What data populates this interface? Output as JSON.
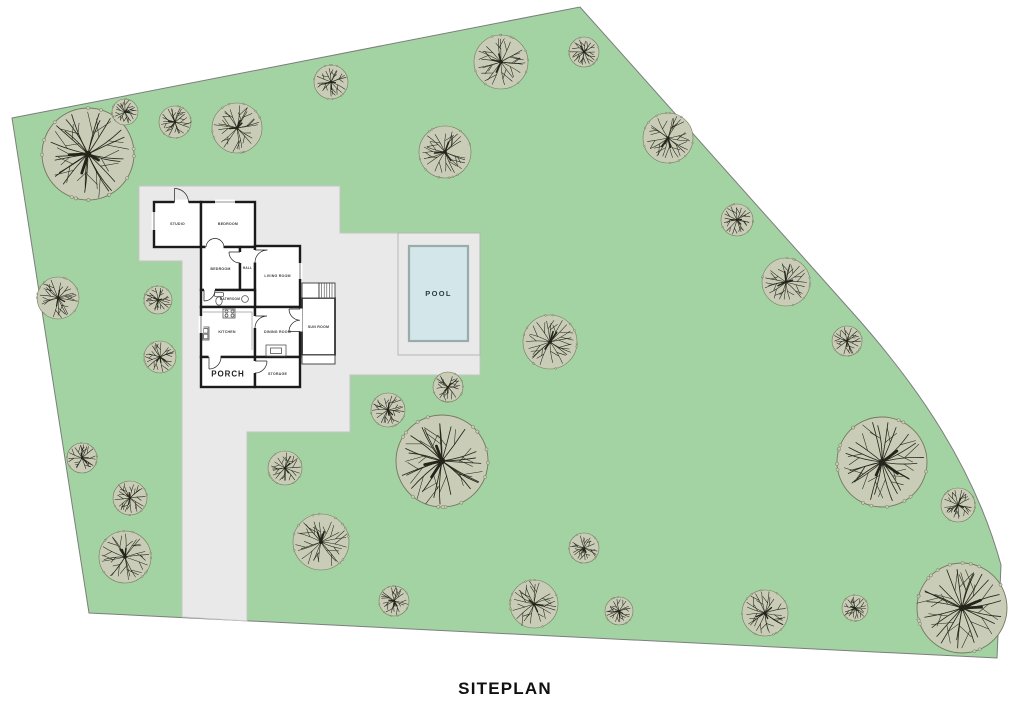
{
  "title": "SITEPLAN",
  "site": {
    "lawn_color": "#a3d3a3",
    "boundary_stroke": "#7d7d7d",
    "trees": {
      "canopy_color": "#c9ccb7",
      "canopy_edge": "#75795e",
      "branch_color": "#24241a",
      "positions": [
        {
          "x": 88,
          "y": 154,
          "r": 46
        },
        {
          "x": 125,
          "y": 112,
          "r": 13
        },
        {
          "x": 175,
          "y": 122,
          "r": 16
        },
        {
          "x": 237,
          "y": 128,
          "r": 25
        },
        {
          "x": 331,
          "y": 82,
          "r": 17
        },
        {
          "x": 445,
          "y": 152,
          "r": 26
        },
        {
          "x": 501,
          "y": 62,
          "r": 27
        },
        {
          "x": 584,
          "y": 52,
          "r": 15
        },
        {
          "x": 668,
          "y": 138,
          "r": 25
        },
        {
          "x": 737,
          "y": 220,
          "r": 16
        },
        {
          "x": 786,
          "y": 282,
          "r": 24
        },
        {
          "x": 847,
          "y": 341,
          "r": 15
        },
        {
          "x": 58,
          "y": 298,
          "r": 21
        },
        {
          "x": 158,
          "y": 300,
          "r": 14
        },
        {
          "x": 160,
          "y": 357,
          "r": 16
        },
        {
          "x": 82,
          "y": 458,
          "r": 15
        },
        {
          "x": 130,
          "y": 498,
          "r": 17
        },
        {
          "x": 125,
          "y": 557,
          "r": 26
        },
        {
          "x": 285,
          "y": 468,
          "r": 17
        },
        {
          "x": 321,
          "y": 542,
          "r": 28
        },
        {
          "x": 388,
          "y": 410,
          "r": 17
        },
        {
          "x": 448,
          "y": 387,
          "r": 15
        },
        {
          "x": 442,
          "y": 461,
          "r": 46
        },
        {
          "x": 550,
          "y": 342,
          "r": 27
        },
        {
          "x": 584,
          "y": 548,
          "r": 15
        },
        {
          "x": 394,
          "y": 601,
          "r": 15
        },
        {
          "x": 534,
          "y": 604,
          "r": 24
        },
        {
          "x": 619,
          "y": 611,
          "r": 14
        },
        {
          "x": 765,
          "y": 613,
          "r": 23
        },
        {
          "x": 855,
          "y": 608,
          "r": 13
        },
        {
          "x": 882,
          "y": 462,
          "r": 45
        },
        {
          "x": 958,
          "y": 505,
          "r": 17
        },
        {
          "x": 962,
          "y": 608,
          "r": 45
        }
      ]
    }
  },
  "hardscape": {
    "pad_color": "#e9e9e9",
    "edge_color": "#c4c4c4"
  },
  "pool": {
    "label": "POOL",
    "water_color": "#d3e6ea",
    "border_color": "#9aabab"
  },
  "plan": {
    "rooms": [
      {
        "label": "STUDIO"
      },
      {
        "label": "BEDROOM"
      },
      {
        "label": "BEDROOM"
      },
      {
        "label": "HALL"
      },
      {
        "label": "LIVING ROOM"
      },
      {
        "label": "BATHROOM"
      },
      {
        "label": "KITCHEN"
      },
      {
        "label": "DINING ROOM"
      },
      {
        "label": "SUN ROOM"
      },
      {
        "label": "PORCH"
      },
      {
        "label": "STORAGE"
      }
    ]
  }
}
